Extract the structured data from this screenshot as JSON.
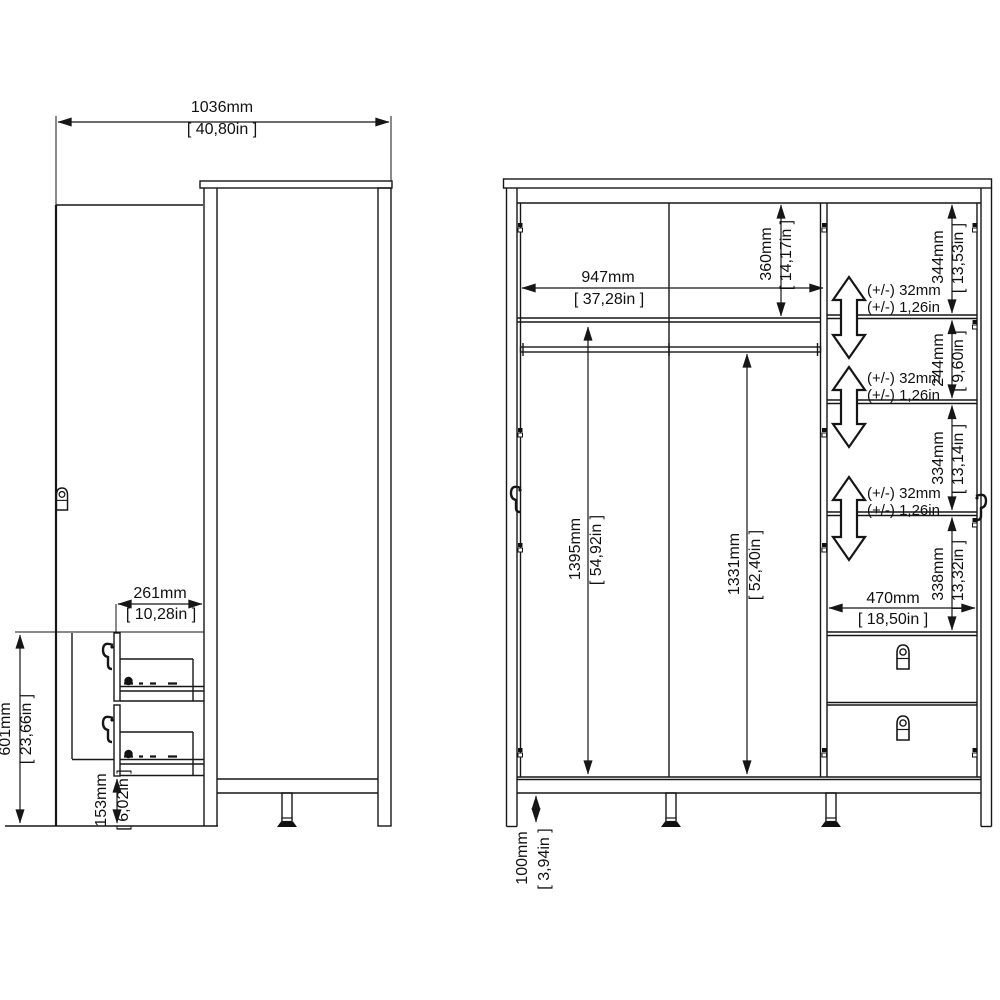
{
  "drawing": {
    "kind": "wardrobe dimension diagram",
    "line_color": "#161616",
    "background_color": "#ffffff",
    "views": {
      "side": {
        "label": "side view with door and drawers open",
        "dimensions": {
          "total_depth_open": {
            "mm": "1036mm",
            "inches": "[ 40,80in ]"
          },
          "drawer_section_height": {
            "mm": "601mm",
            "inches": "[ 23,66in ]"
          },
          "base_height": {
            "mm": "153mm",
            "inches": "[ 6,02in ]"
          },
          "drawer_extension": {
            "mm": "261mm",
            "inches": "[ 10,28in ]"
          }
        }
      },
      "front": {
        "label": "front view with interior shelves and drawers",
        "dimensions": {
          "left_interior_width": {
            "mm": "947mm",
            "inches": "[ 37,28in ]"
          },
          "left_top_compartment_height": {
            "mm": "360mm",
            "inches": "[ 14,17in ]"
          },
          "right_compartment_1_height": {
            "mm": "344mm",
            "inches": "[ 13,53in ]"
          },
          "right_compartment_2_height": {
            "mm": "244mm",
            "inches": "[ 9,60in ]"
          },
          "right_compartment_3_height": {
            "mm": "334mm",
            "inches": "[ 13,14in ]"
          },
          "right_compartment_4_height": {
            "mm": "338mm",
            "inches": "[ 13,32in ]"
          },
          "left_interior_height": {
            "mm": "1395mm",
            "inches": "[ 54,92in ]"
          },
          "right_interior_height": {
            "mm": "1331mm",
            "inches": "[ 52,40in ]"
          },
          "right_interior_width": {
            "mm": "470mm",
            "inches": "[ 18,50in ]"
          },
          "leg_height": {
            "mm": "100mm",
            "inches": "[ 3,94in ]"
          },
          "shelf_adjustability": {
            "mm": "(+/-) 32mm",
            "inches": "(+/-) 1,26in"
          }
        }
      }
    }
  }
}
